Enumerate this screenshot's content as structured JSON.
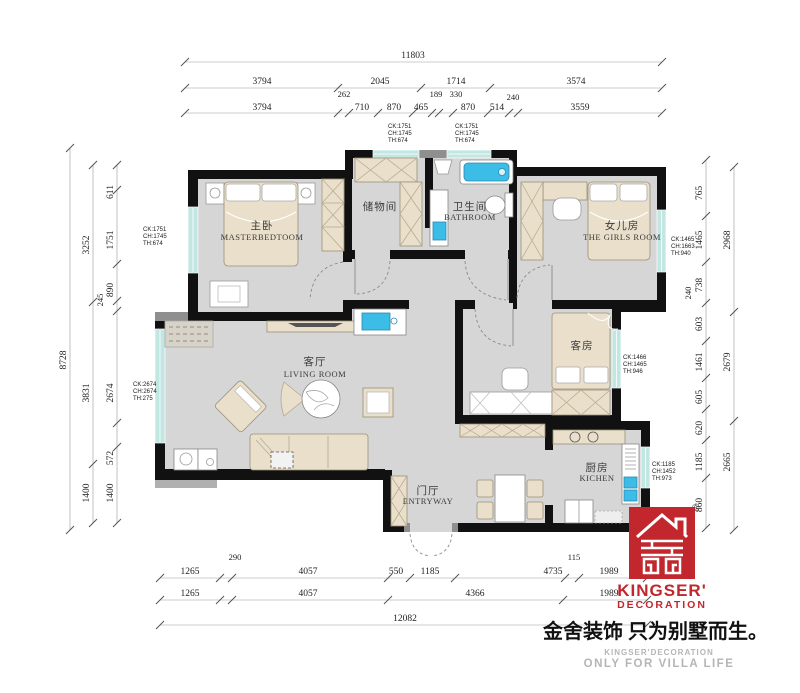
{
  "rooms": {
    "master": {
      "zh": "主卧",
      "en": "MASTERBEDTOOM"
    },
    "storage": {
      "zh": "储物间",
      "en": ""
    },
    "bathroom": {
      "zh": "卫生间",
      "en": "BATHROOM"
    },
    "girls": {
      "zh": "女儿房",
      "en": "THE GIRLS ROOM"
    },
    "living": {
      "zh": "客厅",
      "en": "LIVING ROOM"
    },
    "guest": {
      "zh": "客房",
      "en": ""
    },
    "entry": {
      "zh": "门厅",
      "en": "ENTRYWAY"
    },
    "kitchen": {
      "zh": "厨房",
      "en": "KICHEN"
    }
  },
  "window_tags": {
    "master": {
      "l1": "CK:1751",
      "l2": "CH:1745",
      "l3": "TH:674"
    },
    "top1": {
      "l1": "CK:1751",
      "l2": "CH:1745",
      "l3": "TH:674"
    },
    "top2": {
      "l1": "CK:1751",
      "l2": "CH:1745",
      "l3": "TH:674"
    },
    "girls": {
      "l1": "CK:1465",
      "l2": "CH:1663",
      "l3": "TH:940"
    },
    "guest": {
      "l1": "CK:1466",
      "l2": "CH:1465",
      "l3": "TH:946"
    },
    "living": {
      "l1": "CK:2674",
      "l2": "CH:2674",
      "l3": "TH:275"
    },
    "kitchen": {
      "l1": "CK:1185",
      "l2": "CH:1452",
      "l3": "TH:973"
    }
  },
  "dims": {
    "top": {
      "total": "11803",
      "row2": [
        "3794",
        "2045",
        "1714",
        "3574"
      ],
      "row3": [
        "3794",
        "710",
        "870",
        "465",
        "870",
        "514",
        "3559"
      ],
      "small": [
        "262",
        "189",
        "330",
        "240"
      ]
    },
    "left": {
      "total": "8728",
      "mid": [
        "3252",
        "3831",
        "1400"
      ],
      "inner": [
        "611",
        "1751",
        "890",
        "245",
        "2674",
        "572",
        "1400"
      ]
    },
    "right": {
      "outer": [
        "2968",
        "2679",
        "2665"
      ],
      "inner": [
        "765",
        "1465",
        "738",
        "240",
        "603",
        "1461",
        "605",
        "620",
        "1185",
        "860"
      ]
    },
    "bottom": {
      "row1": [
        "1265",
        "4057",
        "550",
        "1185",
        "4735",
        "1989"
      ],
      "small": [
        "290",
        "115"
      ],
      "row2": [
        "1265",
        "4057",
        "4366",
        "1989"
      ],
      "total": "12082"
    }
  },
  "colors": {
    "wall": "#111111",
    "floor": "#d6d6d6",
    "window": "#c2e6e2",
    "furniture": "#e9dfca",
    "fixture_blue": "#3bbde8",
    "brand_red": "#c1272d"
  },
  "logo": {
    "registered": "®",
    "brand": "KINGSER'",
    "brand_sub": "DECORATION",
    "slogan_zh": "金舍装饰 只为别墅而生。",
    "slogan_en1": "KINGSER'DECORATION",
    "slogan_en2": "ONLY FOR VILLA LIFE"
  }
}
